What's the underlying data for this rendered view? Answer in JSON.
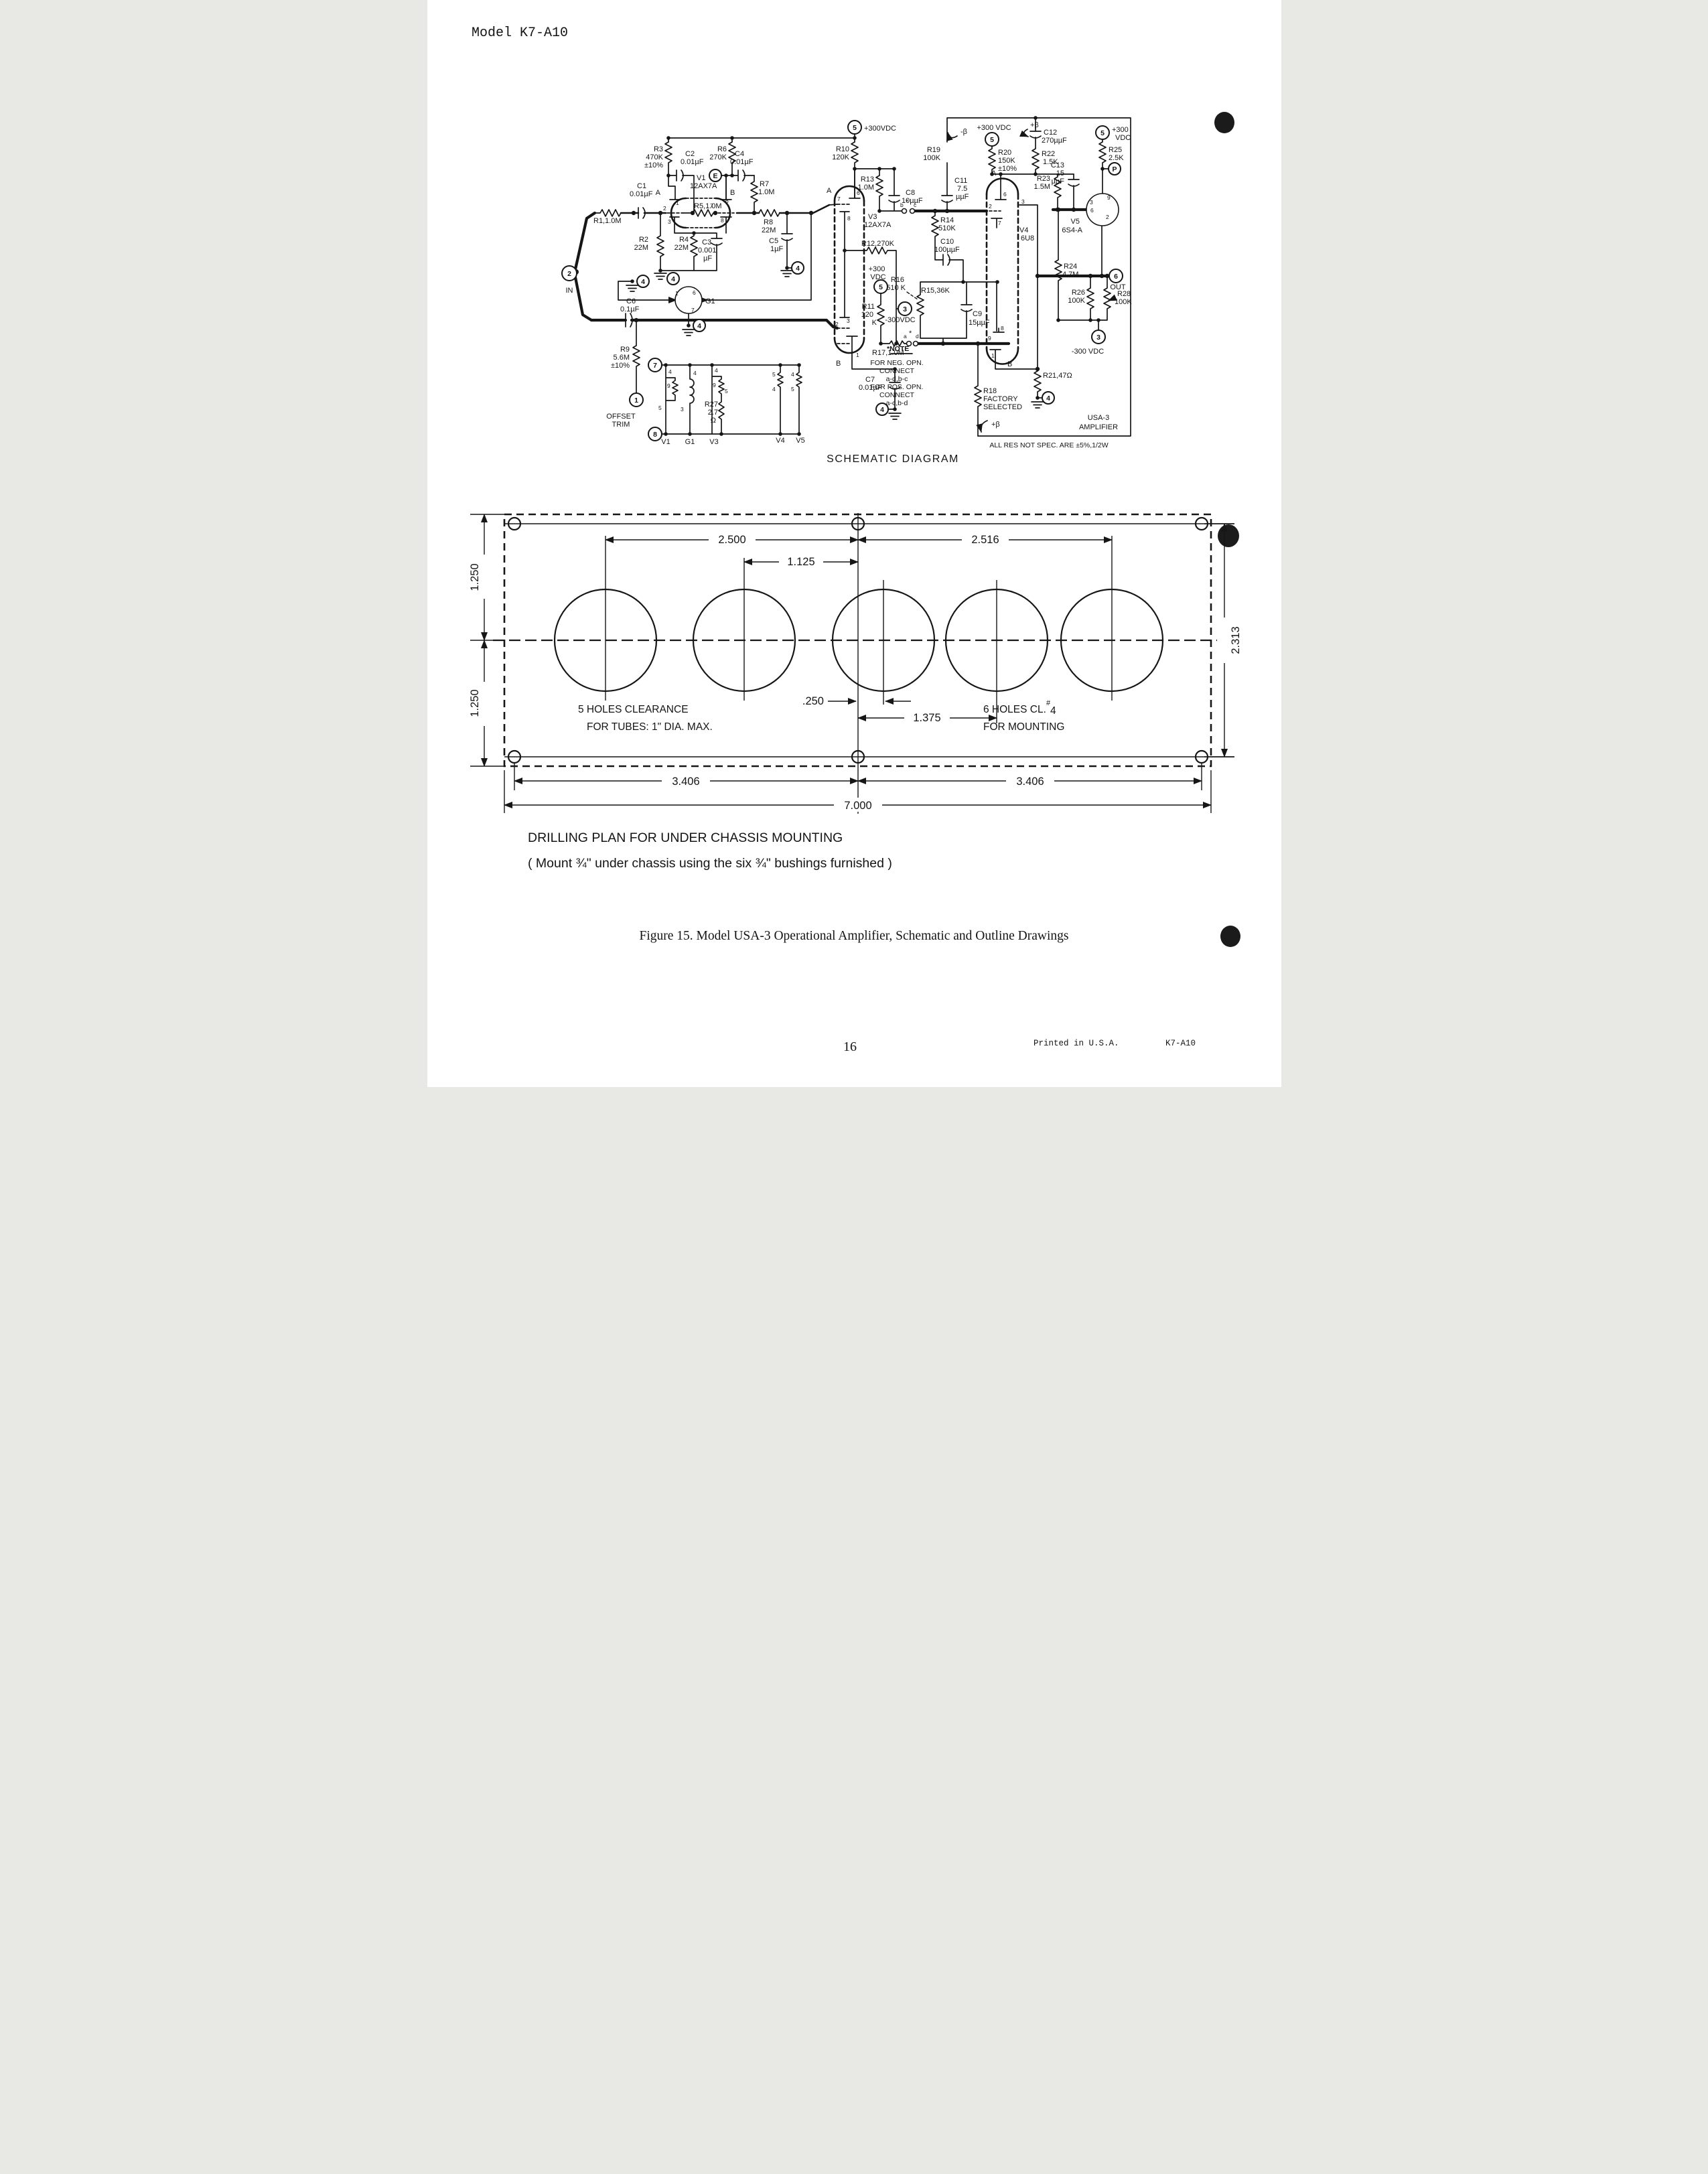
{
  "hd": [
    "Model K7-A10",
    "SCHEMATIC DIAGRAM",
    "Figure 15.  Model USA-3 Operational Amplifier, Schematic and Outline Drawings",
    "16",
    "Printed in U.S.A.",
    "K7-A10"
  ],
  "sl": [
    "R3",
    "470K",
    "±10%",
    "C2",
    "0.01µF",
    "R6",
    "270K",
    "C4",
    "0.01µF",
    "R10",
    "120K",
    "+300VDC",
    "V1",
    "12AX7A",
    "A",
    "B",
    "C1",
    "0.01µF",
    "R1,1.0M",
    "IN",
    "R2",
    "22M",
    "R5,1.0M",
    "R4",
    "22M",
    "C3",
    "0.001",
    "µF",
    "R7",
    "1.0M",
    "R8",
    "22M",
    "C5",
    "1µF",
    "R9",
    "5.6M",
    "±10%",
    "OFFSET",
    "TRIM",
    "C6",
    "0.1µF",
    "G1",
    "R11",
    "120",
    "K",
    "+300",
    "VDC",
    "-300VDC",
    "R13",
    "1.0M",
    "C8",
    "10µµF",
    "V3",
    "12AX7A",
    "R12,270K",
    "R17,1.0M",
    "C7",
    "0.01µF",
    "R14",
    "510K",
    "C10",
    "100µµF",
    "R15,36K",
    "R16",
    "510 K",
    "C9",
    "15µµF",
    "R18",
    "FACTORY",
    "SELECTED",
    "R21,47Ω",
    "+β",
    "-β",
    "+β",
    "R19",
    "100K",
    "+300 VDC",
    "R20",
    "150K",
    "±10%",
    "C12",
    "270µµF",
    "R22",
    "1.5K",
    "C11",
    "7.5",
    "µµF",
    "R23",
    "1.5M",
    "C13",
    "15",
    "µµF",
    "R24",
    "4.7M",
    "R26",
    "100K",
    "R28",
    "100K",
    "+300",
    "VDC",
    "R25",
    "2.5K",
    "OUT",
    "-300 VDC",
    "V5",
    "6S4-A",
    "V4",
    "6U8",
    "R27",
    "2.7",
    "Ω",
    "V1",
    "G1",
    "V3",
    "V4",
    "V5",
    "b",
    "*",
    "c",
    "a",
    "*",
    "d"
  ],
  "sp": [
    "1",
    "2",
    "3",
    "7",
    "6",
    "8",
    "1",
    "6",
    "7",
    "7",
    "6",
    "8",
    "A",
    "2",
    "3",
    "1",
    "B",
    "2",
    "6",
    "3",
    "7",
    "A",
    "9",
    "8",
    "1",
    "B",
    "9",
    "3",
    "6",
    "2",
    "4",
    "9",
    "5",
    "4",
    "3",
    "4",
    "9",
    "5",
    "5",
    "4",
    "4",
    "5"
  ],
  "st": [
    "5",
    "E",
    "2",
    "4",
    "1",
    "4",
    "4",
    "5",
    "3",
    "4",
    "5",
    "5",
    "P",
    "6",
    "3",
    "4",
    "7",
    "8",
    "4"
  ],
  "nt": [
    "*NOTE",
    "FOR NEG. OPN.",
    "CONNECT",
    "a-d,b-c",
    "FOR POS. OPN.",
    "CONNECT",
    "a-c,b-d"
  ],
  "bx": [
    "USA-3",
    "AMPLIFIER"
  ],
  "spec": "ALL RES NOT SPEC. ARE ±5%,1/2W",
  "dr": [
    "2.500",
    "2.516",
    "1.125",
    ".250",
    "1.375",
    "1.250",
    "1.250",
    "2.313",
    "3.406",
    "3.406",
    "7.000",
    "5 HOLES CLEARANCE",
    "FOR TUBES: 1\" DIA. MAX.",
    "6 HOLES CL.",
    "#",
    "4",
    "FOR MOUNTING",
    "DRILLING PLAN FOR UNDER CHASSIS MOUNTING",
    "( Mount ¾\" under chassis using the six ¾\" bushings furnished )"
  ]
}
